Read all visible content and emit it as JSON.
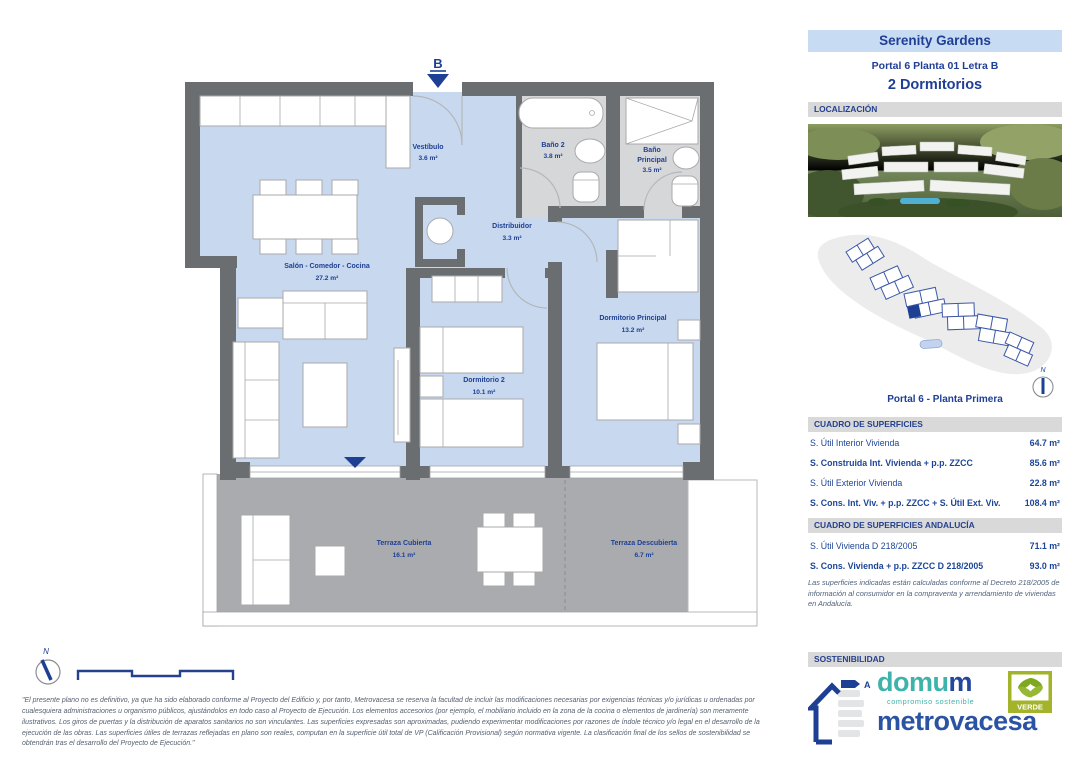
{
  "header": {
    "project": "Serenity Gardens",
    "unit": "Portal 6 Planta 01 Letra B",
    "type": "2 Dormitorios"
  },
  "sections": {
    "location": "LOCALIZACIÓN",
    "surfaces": "CUADRO DE SUPERFICIES",
    "surfaces_andalucia": "CUADRO DE SUPERFICIES ANDALUCÍA",
    "sustainability": "SOSTENIBILIDAD"
  },
  "plan": {
    "entrance_label": "B",
    "north_label": "N",
    "rooms": [
      {
        "name": "Vestíbulo",
        "area": "3.6 m²"
      },
      {
        "name": "Salón - Comedor - Cocina",
        "area": "27.2 m²"
      },
      {
        "name": "Distribuidor",
        "area": "3.3 m²"
      },
      {
        "name": "Baño 2",
        "area": "3.8 m²"
      },
      {
        "name": "Baño Principal",
        "name_lines": [
          "Baño",
          "Principal"
        ],
        "area": "3.5 m²"
      },
      {
        "name": "Dormitorio 2",
        "area": "10.1 m²"
      },
      {
        "name": "Dormitorio Principal",
        "area": "13.2 m²"
      },
      {
        "name": "Terraza Cubierta",
        "area": "16.1 m²"
      },
      {
        "name": "Terraza Descubierta",
        "area": "6.7 m²"
      }
    ]
  },
  "site_plan": {
    "caption": "Portal 6 - Planta Primera",
    "north_label": "N"
  },
  "surfaces_table": {
    "rows": [
      {
        "label": "S. Útil Interior Vivienda",
        "value": "64.7 m²"
      },
      {
        "label": "S. Construida Int. Vivienda + p.p. ZZCC",
        "value": "85.6 m²"
      },
      {
        "label": "S. Útil Exterior Vivienda",
        "value": "22.8 m²"
      },
      {
        "label": "S. Cons. Int. Viv. + p.p. ZZCC + S. Útil Ext. Viv.",
        "value": "108.4 m²"
      }
    ]
  },
  "andalucia_table": {
    "rows": [
      {
        "label": "S. Útil Vivienda D 218/2005",
        "value": "71.1 m²"
      },
      {
        "label": "S. Cons. Vivienda + p.p. ZZCC D 218/2005",
        "value": "93.0 m²"
      }
    ],
    "note": "Las superficies indicadas están calculadas conforme al Decreto 218/2005 de información al consumidor en la compraventa y arrendamiento de viviendas en Andalucía."
  },
  "sustainability": {
    "energy_rating": "A",
    "domum_prefix": "domu",
    "domum_suffix": "m",
    "domum_tagline": "compromiso sostenible",
    "metrovacesa": "metrovacesa",
    "verde": "VERDE"
  },
  "disclaimer": "\"El presente plano no es definitivo, ya que ha sido elaborado conforme al Proyecto del Edificio y, por tanto, Metrovacesa se reserva la facultad de incluir las modificaciones necesarias por exigencias técnicas y/o jurídicas u ordenadas por cualesquiera administraciones u organismo públicos, ajustándolos en todo caso al Proyecto de Ejecución. Los elementos accesorios (por ejemplo, el mobiliario incluido en la zona de la cocina o elementos de jardinería) son meramente ilustrativos. Los giros de puertas y la distribución de aparatos sanitarios no son vinculantes. Las superficies expresadas son aproximadas, pudiendo experimentar modificaciones por razones de índole técnico y/o legal en el desarrollo de la ejecución de las obras. Las superficies útiles de terrazas reflejadas en plano son reales, computan en la superficie útil total de VP (Calificación Provisional) según normativa vigente. La clasificación final de los sellos de sostenibilidad se obtendrán tras el desarrollo del Proyecto de Ejecución.\"",
  "colors": {
    "accent_navy": "#1f3e96",
    "title_box_bg": "#c7dbf3",
    "section_bar_bg": "#d9d9d9",
    "floor_blue": "#c8d9ef",
    "bath_gray": "#d6d7d8",
    "terrace_gray": "#a9abae",
    "wall_gray": "#6b6e71",
    "domum_teal": "#3db3ab",
    "metrovacesa_blue": "#2a53a3",
    "verde_green": "#a3b42a"
  }
}
